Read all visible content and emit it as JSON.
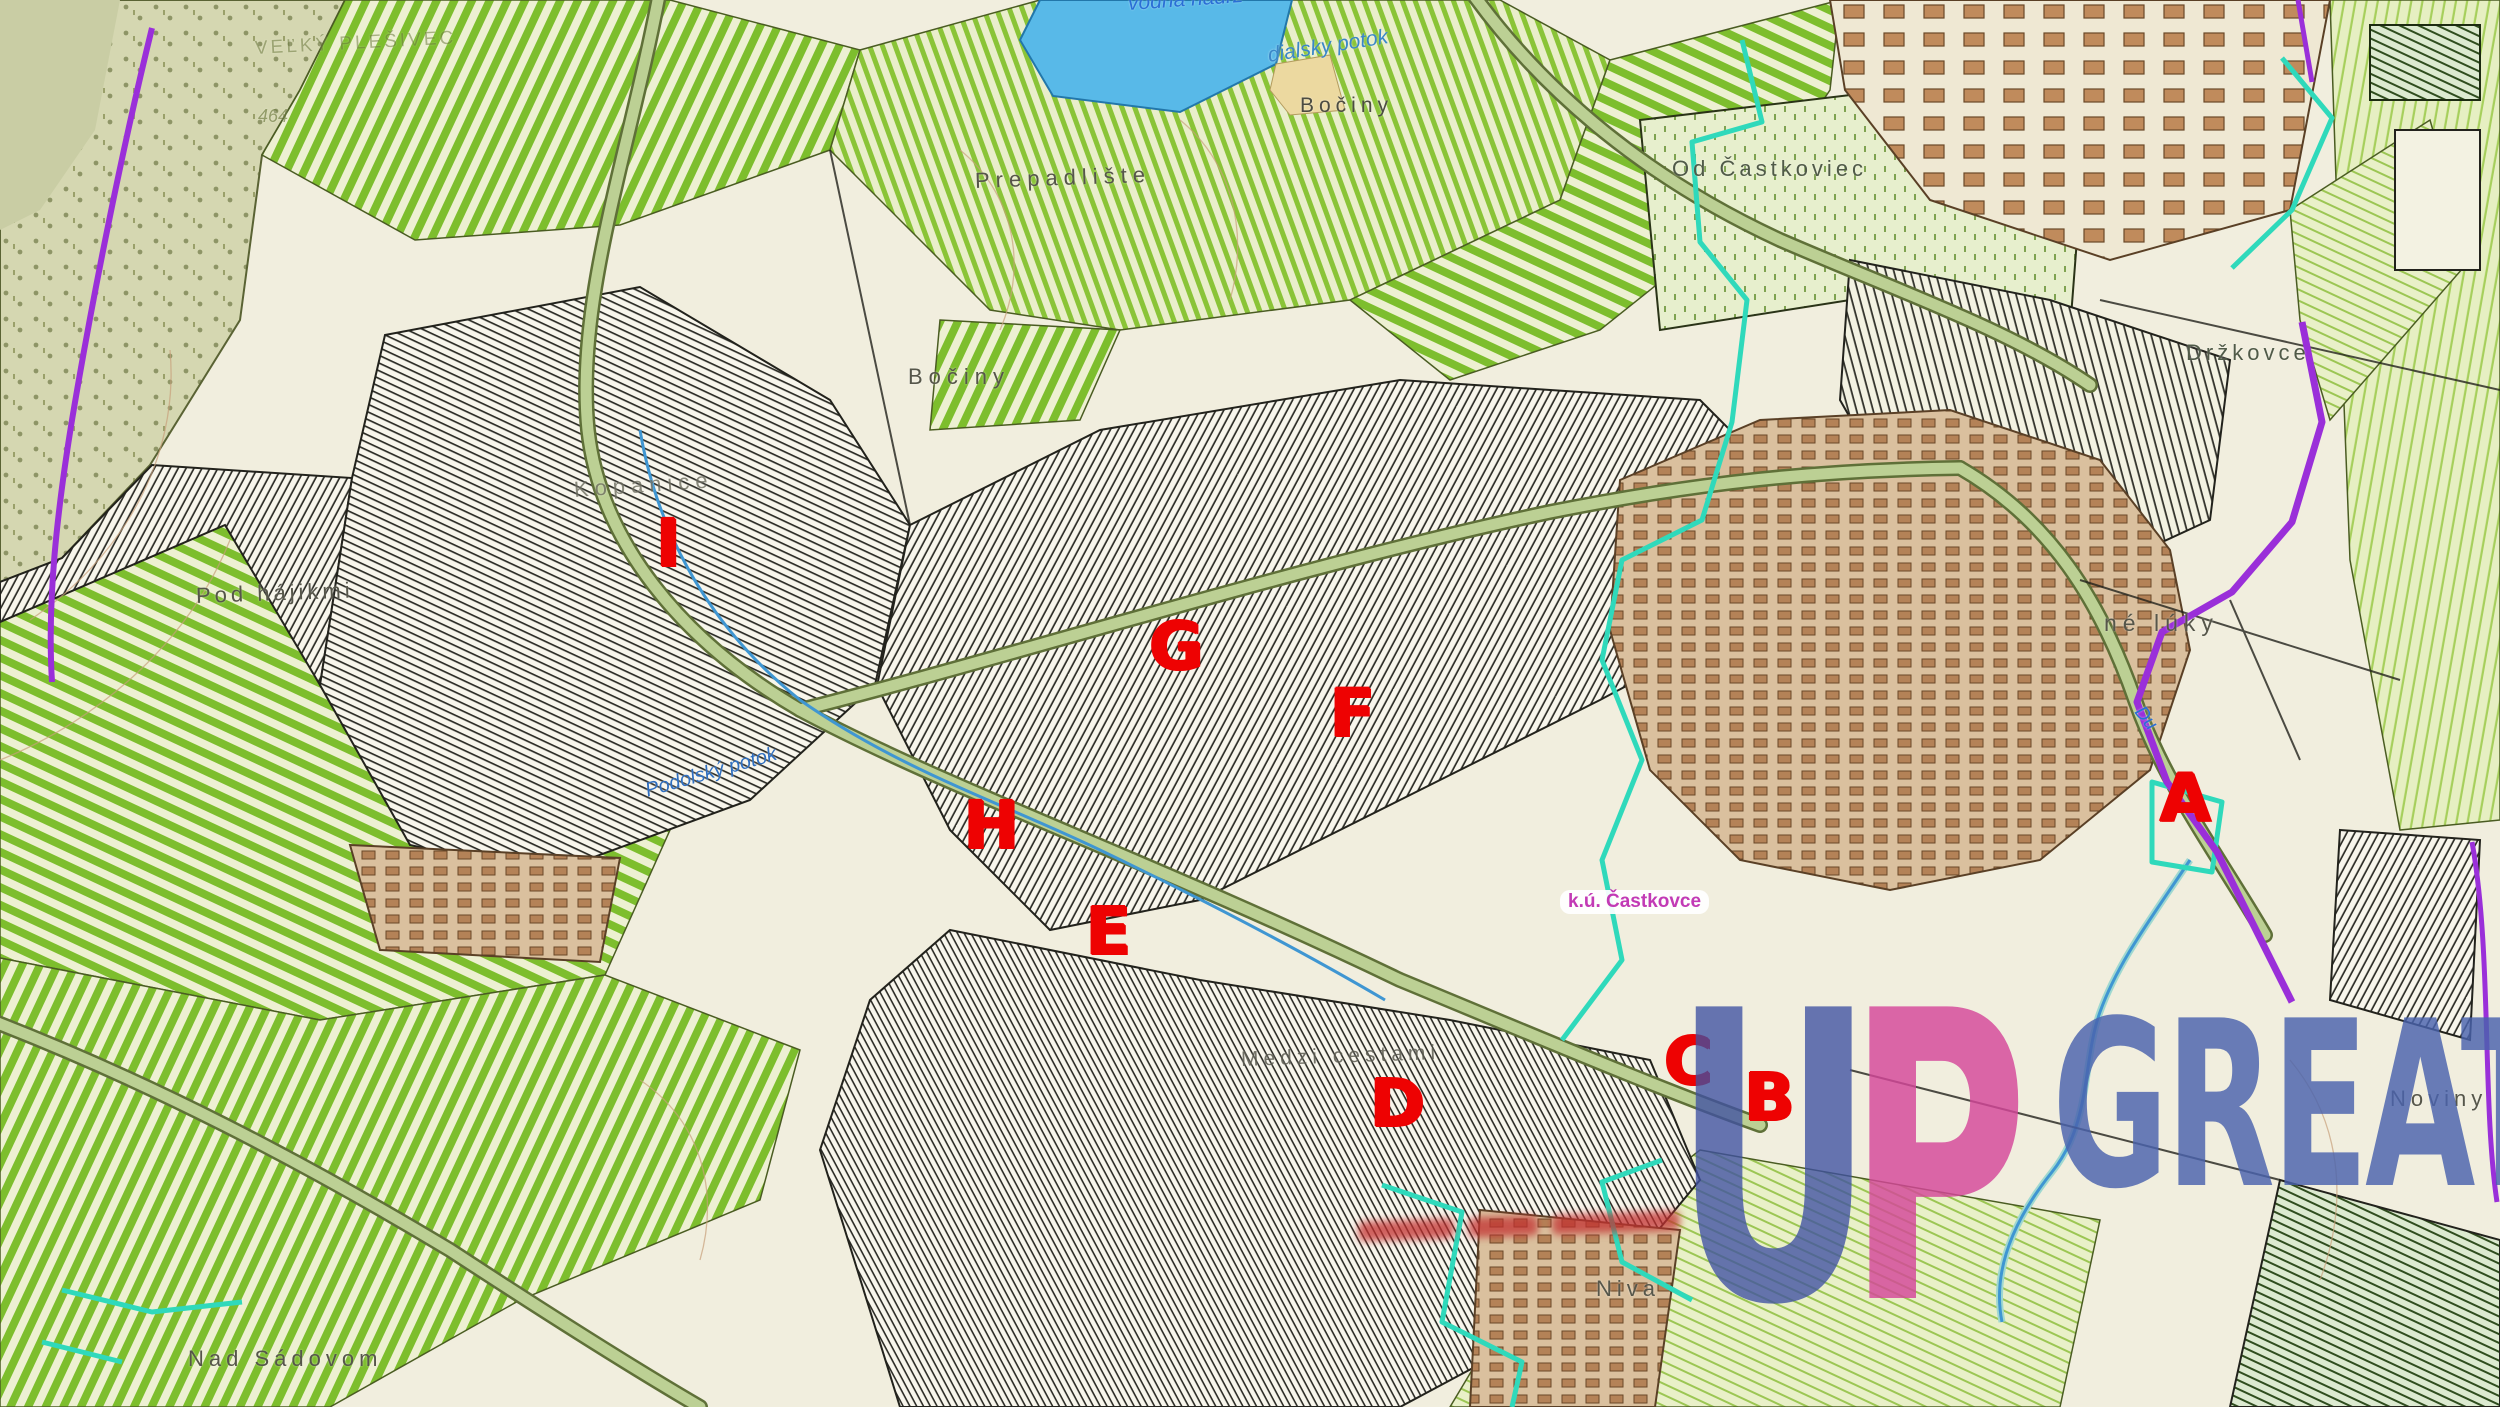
{
  "map": {
    "labels": [
      {
        "name": "label-velky-plesivec",
        "text": "VEĽKÝ PLEŠIVEC",
        "x": 255,
        "y": 38,
        "size": 19,
        "color": "#6f7c42",
        "ls": 3,
        "rot": -3,
        "opacity": 0.55
      },
      {
        "name": "label-elevation-464",
        "text": "464",
        "x": 258,
        "y": 106,
        "size": 18,
        "color": "#6f7c42",
        "italic": true,
        "opacity": 0.65
      },
      {
        "name": "label-vodna-nadrz",
        "text": "vodná nádrž",
        "x": 1128,
        "y": -8,
        "size": 21,
        "color": "#2a6fd6",
        "italic": true,
        "rot": -4
      },
      {
        "name": "label-dialsky-potok",
        "text": "dialsky potok",
        "x": 1268,
        "y": 44,
        "size": 21,
        "color": "#3a87c8",
        "italic": true,
        "rot": -9
      },
      {
        "name": "label-bociny-top",
        "text": "Bočiny",
        "x": 1300,
        "y": 94,
        "size": 21,
        "color": "#4c4c42",
        "ls": 5
      },
      {
        "name": "label-prepadliste",
        "text": "Prepadlište",
        "x": 975,
        "y": 168,
        "size": 22,
        "color": "#56564a",
        "ls": 6,
        "rot": -2
      },
      {
        "name": "label-od-castkoviec",
        "text": "Od Častkoviec",
        "x": 1672,
        "y": 156,
        "size": 22,
        "color": "#505a48",
        "ls": 4
      },
      {
        "name": "label-drzkovce",
        "text": "Držkovce",
        "x": 2186,
        "y": 340,
        "size": 22,
        "color": "#505a48",
        "ls": 4
      },
      {
        "name": "label-bociny-mid",
        "text": "Bočiny",
        "x": 908,
        "y": 364,
        "size": 22,
        "color": "#56564a",
        "ls": 6
      },
      {
        "name": "label-kopanice",
        "text": "Kopanice",
        "x": 574,
        "y": 477,
        "size": 22,
        "color": "#6e6e60",
        "ls": 6,
        "rot": -4,
        "opacity": 0.8
      },
      {
        "name": "label-pod-hajikmi",
        "text": "Pod hájikmi",
        "x": 196,
        "y": 583,
        "size": 22,
        "color": "#56564a",
        "ls": 4,
        "rot": -2
      },
      {
        "name": "label-ne-luky",
        "text": "né lúky",
        "x": 2104,
        "y": 610,
        "size": 23,
        "color": "#56564a",
        "ls": 6
      },
      {
        "name": "label-du",
        "text": "Du",
        "x": 2138,
        "y": 698,
        "size": 19,
        "color": "#2a6fd6",
        "italic": true,
        "rot": 52
      },
      {
        "name": "label-podolsky-potok",
        "text": "Podolský potok",
        "x": 646,
        "y": 780,
        "size": 20,
        "color": "#2f6fc0",
        "italic": true,
        "rot": -16
      },
      {
        "name": "label-ku-castkovce",
        "text": "k.ú. Častkovce",
        "x": 1560,
        "y": 890,
        "size": 19,
        "color": "#c23ab5",
        "pill": true
      },
      {
        "name": "label-medzi-cestami",
        "text": "Medzi cestami",
        "x": 1241,
        "y": 1048,
        "size": 21,
        "color": "#5c5c50",
        "ls": 5,
        "rot": -2,
        "opacity": 0.85
      },
      {
        "name": "label-noviny",
        "text": "Noviny",
        "x": 2390,
        "y": 1086,
        "size": 22,
        "color": "#56564a",
        "ls": 5
      },
      {
        "name": "label-niva",
        "text": "Niva",
        "x": 1596,
        "y": 1276,
        "size": 22,
        "color": "#56564a",
        "ls": 5
      },
      {
        "name": "label-nad-sadovom",
        "text": "Nad Sádovom",
        "x": 188,
        "y": 1346,
        "size": 22,
        "color": "#56564a",
        "ls": 5
      }
    ],
    "markers": [
      {
        "name": "marker-a",
        "text": "A",
        "x": 2185,
        "y": 799,
        "size": 66,
        "color": "#ee0202",
        "anchor": "center"
      },
      {
        "name": "marker-b",
        "text": "B",
        "x": 1769,
        "y": 1098,
        "size": 66,
        "color": "#ee0202",
        "anchor": "center"
      },
      {
        "name": "marker-c",
        "text": "C",
        "x": 1688,
        "y": 1062,
        "size": 66,
        "color": "#ee0202",
        "anchor": "center"
      },
      {
        "name": "marker-d",
        "text": "D",
        "x": 1397,
        "y": 1104,
        "size": 66,
        "color": "#ee0202",
        "anchor": "center"
      },
      {
        "name": "marker-e",
        "text": "E",
        "x": 1108,
        "y": 932,
        "size": 66,
        "color": "#ee0202",
        "anchor": "center"
      },
      {
        "name": "marker-f",
        "text": "F",
        "x": 1352,
        "y": 714,
        "size": 66,
        "color": "#ee0202",
        "anchor": "center"
      },
      {
        "name": "marker-g",
        "text": "G",
        "x": 1176,
        "y": 647,
        "size": 66,
        "color": "#ee0202",
        "anchor": "center"
      },
      {
        "name": "marker-h",
        "text": "H",
        "x": 991,
        "y": 826,
        "size": 66,
        "color": "#ee0202",
        "anchor": "center"
      },
      {
        "name": "marker-i",
        "text": "I",
        "x": 668,
        "y": 544,
        "size": 66,
        "color": "#ee0202",
        "anchor": "center"
      }
    ],
    "watermark": {
      "u": "U",
      "p": "P",
      "great": "GREAT",
      "u_color": "#3f51a3",
      "p_color": "#d5479a",
      "great_color": "#4a63ae"
    },
    "palette": {
      "background_cream": "#f1eede",
      "field_green": "#7dbe2d",
      "meadow_lime": "#a6cf5c",
      "forest_olive": "#d5d7b1",
      "water_blue": "#58b9e8",
      "built_up_brown": "#b48257",
      "cadastre_boundary_cyan": "#2fd9bb",
      "boundary_purple": "#9a2fd9",
      "marker_red": "#ee0202",
      "contour_brown": "#c8a07a"
    }
  }
}
